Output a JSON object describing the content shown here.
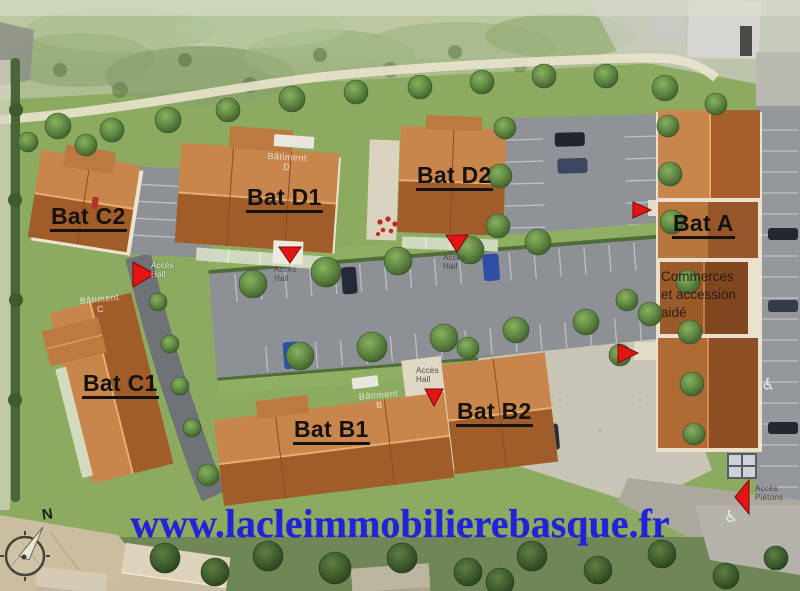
{
  "type": "real-estate-site-plan",
  "buildings": {
    "a": {
      "label": "Bat A"
    },
    "b1": {
      "label": "Bat B1"
    },
    "b2": {
      "label": "Bat B2"
    },
    "c1": {
      "label": "Bat C1"
    },
    "c2": {
      "label": "Bat C2"
    },
    "d1": {
      "label": "Bat D1"
    },
    "d2": {
      "label": "Bat D2"
    }
  },
  "commerce_note": {
    "line1": "Commerces",
    "line2": "et accession",
    "line3": "aidé"
  },
  "annotations": {
    "acces_hall": "Accès Hall",
    "acces_pietons": "Accès Piétons"
  },
  "roof_labels": {
    "word": "Bâtiment",
    "letter_c": "C",
    "letter_d": "D",
    "letter_b": "B"
  },
  "compass": {
    "north": "N"
  },
  "footer": {
    "website": "www.lacleimmobilierebasque.fr"
  },
  "colors": {
    "roof_light": "#c4824a",
    "roof_dark": "#9a5a2a",
    "grass": "#8cab60",
    "asphalt": "#8d9196",
    "url_blue": "#2222dd",
    "arrow_red": "#e31414",
    "label_black": "#16120e"
  }
}
